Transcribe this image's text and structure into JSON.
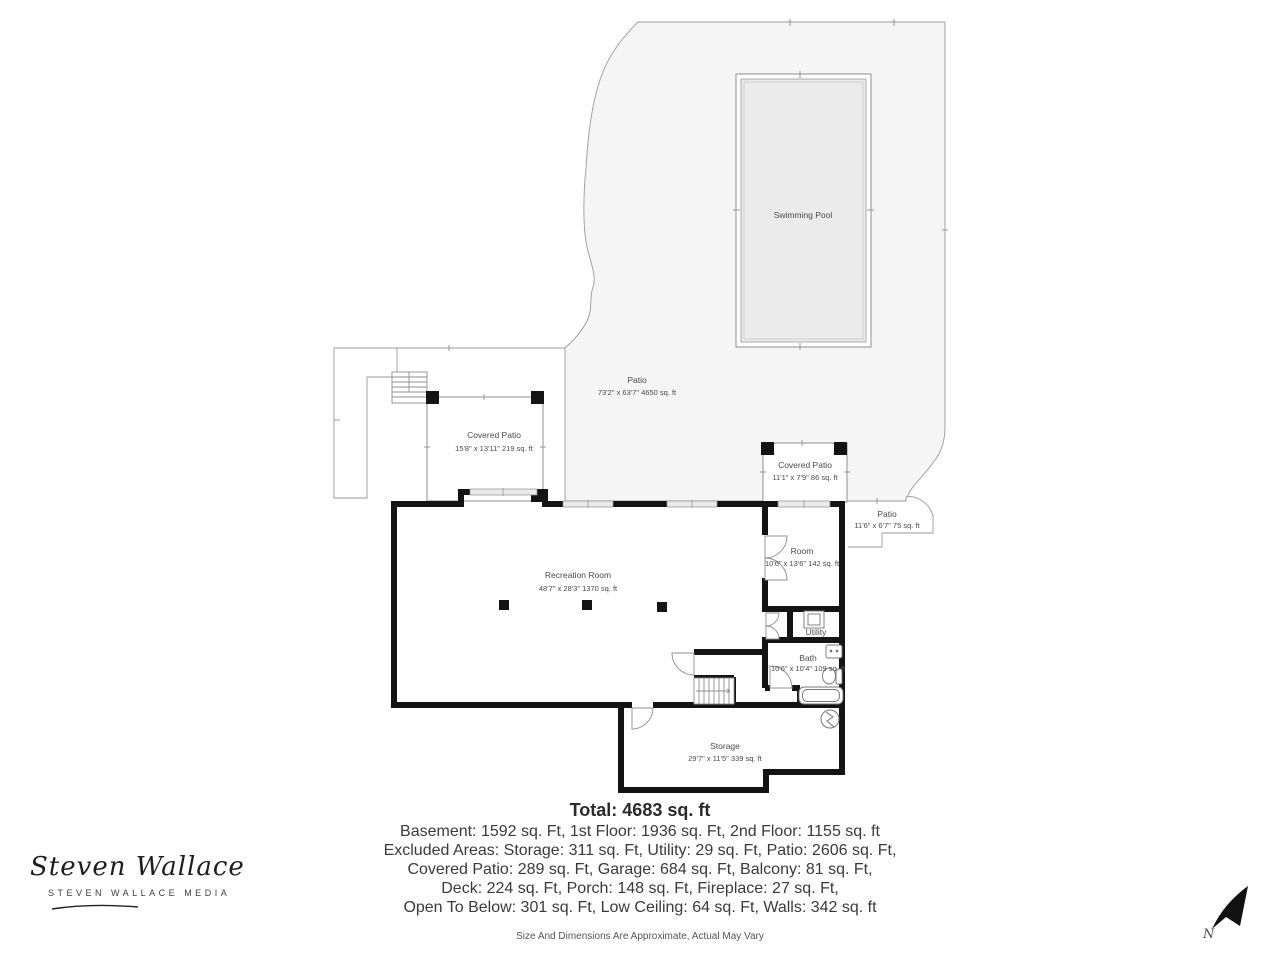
{
  "rooms": {
    "swimming_pool": {
      "label": "Swimming Pool"
    },
    "patio_main": {
      "label": "Patio",
      "dims": "73'2\" x 63'7\" 4650 sq. ft"
    },
    "covered_patio_left": {
      "label": "Covered Patio",
      "dims": "15'8\" x 13'11\" 219 sq. ft"
    },
    "covered_patio_right": {
      "label": "Covered Patio",
      "dims": "11'1\" x 7'9\" 86 sq. ft"
    },
    "patio_right": {
      "label": "Patio",
      "dims": "11'6\" x 6'7\" 75 sq. ft"
    },
    "recreation_room": {
      "label": "Recreation Room",
      "dims": "48'7\" x 28'3\" 1370 sq. ft"
    },
    "room": {
      "label": "Room",
      "dims": "10'6\" x 13'6\" 142 sq. ft"
    },
    "utility": {
      "label": "Utility"
    },
    "bath": {
      "label": "Bath",
      "dims": "10'6\" x 10'4\" 109 sq. ft"
    },
    "storage": {
      "label": "Storage",
      "dims": "29'7\" x 11'5\" 339 sq. ft"
    }
  },
  "summary": {
    "total": "Total: 4683 sq. ft",
    "line1": "Basement: 1592 sq. Ft, 1st Floor: 1936 sq. Ft, 2nd Floor: 1155 sq. ft",
    "line2": "Excluded Areas: Storage: 311 sq. Ft, Utility: 29 sq. Ft, Patio: 2606 sq. Ft,",
    "line3": "Covered Patio: 289 sq. Ft, Garage: 684 sq. Ft, Balcony: 81 sq. Ft,",
    "line4": "Deck: 224 sq. Ft, Porch: 148 sq. Ft, Fireplace: 27 sq. Ft,",
    "line5": "Open To Below: 301 sq. Ft, Low Ceiling: 64 sq. Ft, Walls: 342 sq. ft",
    "disclaimer": "Size And Dimensions Are Approximate, Actual May Vary"
  },
  "branding": {
    "logo_script": "Steven Wallace",
    "logo_sub": "STEVEN WALLACE MEDIA"
  },
  "compass": {
    "north_label": "N"
  },
  "colors": {
    "wall": "#141414",
    "thin_line": "#8f8f8f",
    "patio_fill": "#f5f5f5",
    "pool_fill": "#ebebeb",
    "window_fill": "#e9e9e9"
  }
}
